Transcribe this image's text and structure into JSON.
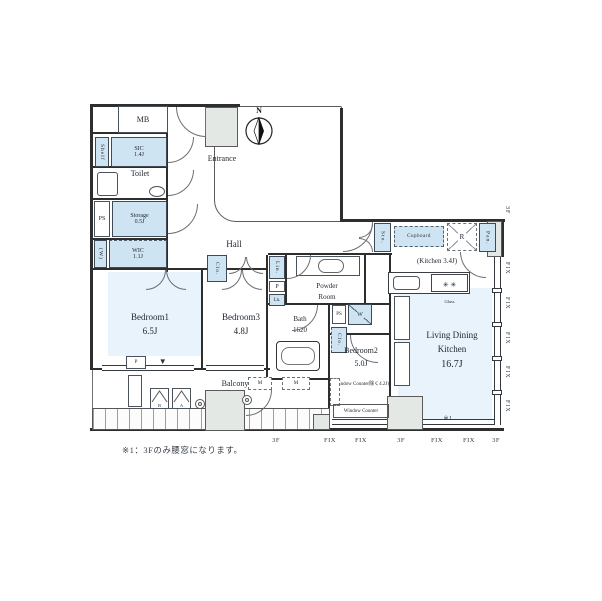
{
  "plan": {
    "note": "※1：3Fのみ腰窓になります。",
    "compass_n": "N",
    "section_marker": "▼",
    "ref_marker": "※1"
  },
  "rooms": {
    "mb": {
      "label": "MB"
    },
    "shelf": {
      "label": "Shelf"
    },
    "sic": {
      "label": "SIC",
      "size": "1.4J"
    },
    "entrance": {
      "label": "Entrance"
    },
    "toilet": {
      "label": "Toilet"
    },
    "ps_entry": {
      "label": "PS"
    },
    "storage": {
      "label": "Storage",
      "size": "0.5J"
    },
    "wic": {
      "label": "WIC",
      "size": "1.1J",
      "side": "(W)"
    },
    "hall": {
      "label": "Hall"
    },
    "bedroom1": {
      "label": "Bedroom1",
      "size": "6.5J"
    },
    "bedroom3": {
      "label": "Bedroom3",
      "size": "4.8J"
    },
    "bedroom2": {
      "label": "Bedroom2",
      "size": "5.0J",
      "note": "(Window Counter除く4.2J)"
    },
    "bath": {
      "label": "Bath",
      "size": "1620"
    },
    "powder_room": {
      "line1": "Powder",
      "line2": "Room"
    },
    "ldk": {
      "line1": "Living Dining",
      "line2": "Kitchen",
      "size": "16.7J"
    },
    "kitchen": {
      "label": "(Kitchen 3.4J)"
    },
    "balcony": {
      "label": "Balcony"
    },
    "window_counter": {
      "label": "Window Counter"
    }
  },
  "fixtures": {
    "clo_hall": "Clo.",
    "lin": "Lin.",
    "p_shaft": "P",
    "ln": "Ln.",
    "ps_bath": "PS",
    "washer": "W",
    "clo_bedroom2": "Clo.",
    "sto": "Sto.",
    "cupboard": "Cupboard",
    "fridge": "R",
    "pantry": "Pan.",
    "stove_burners": "✳ ✳",
    "stove_glass": "Glass",
    "meter": "M",
    "ac_a": "A",
    "ac_b": "B",
    "p_balcony": "P"
  },
  "markers": {
    "fix": "FIX",
    "floor": "3F"
  }
}
